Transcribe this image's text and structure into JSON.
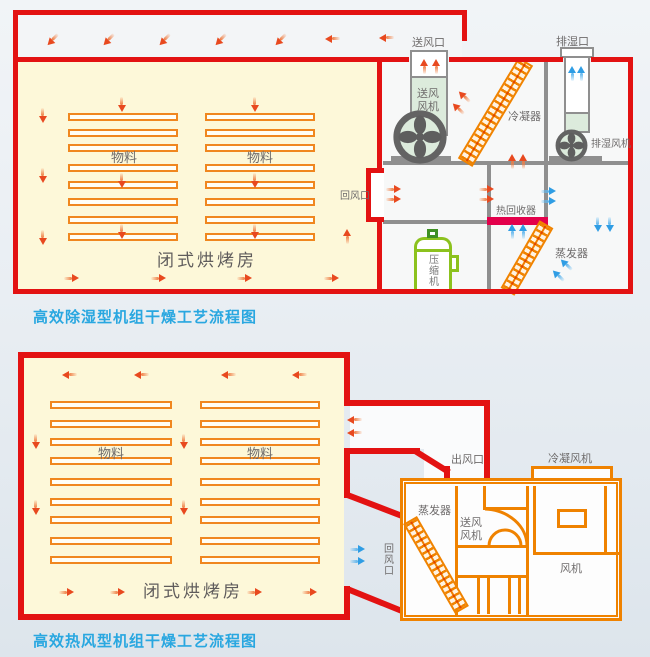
{
  "colors": {
    "structure_red": "#e31212",
    "unit_orange": "#ef8200",
    "room_yellow": "#fdf8d9",
    "orange_arrow": "#e8491f",
    "blue_arrow": "#2f9de4",
    "compressor_green": "#8cc21e",
    "heat_recovery_crimson": "#e3004b",
    "machine_gray": "#8f8f8f",
    "caption_blue": "#29a7e0"
  },
  "top_diagram": {
    "caption": "高效除湿型机组干燥工艺流程图",
    "room_label": "闭式烘烤房",
    "material_left": "物料",
    "material_right": "物料",
    "return_air_label": "回风口",
    "supply_outlet_label": "送风口",
    "supply_fan_label": "送风\n风机",
    "condenser_label": "冷凝器",
    "exhaust_outlet_label": "排湿口",
    "exhaust_fan_label": "排湿风机",
    "heat_recovery_label": "热回收器",
    "compressor_label": "压缩机",
    "evaporator_label": "蒸发器"
  },
  "bottom_diagram": {
    "caption": "高效热风型机组干燥工艺流程图",
    "room_label": "闭式烘烤房",
    "material_left": "物料",
    "material_right": "物料",
    "air_outlet_label": "出风口",
    "return_air_label": "回风口",
    "condenser_fan_label": "冷凝风机",
    "evaporator_label": "蒸发器",
    "supply_fan_label": "送风\n风机",
    "fan_label": "风机"
  }
}
